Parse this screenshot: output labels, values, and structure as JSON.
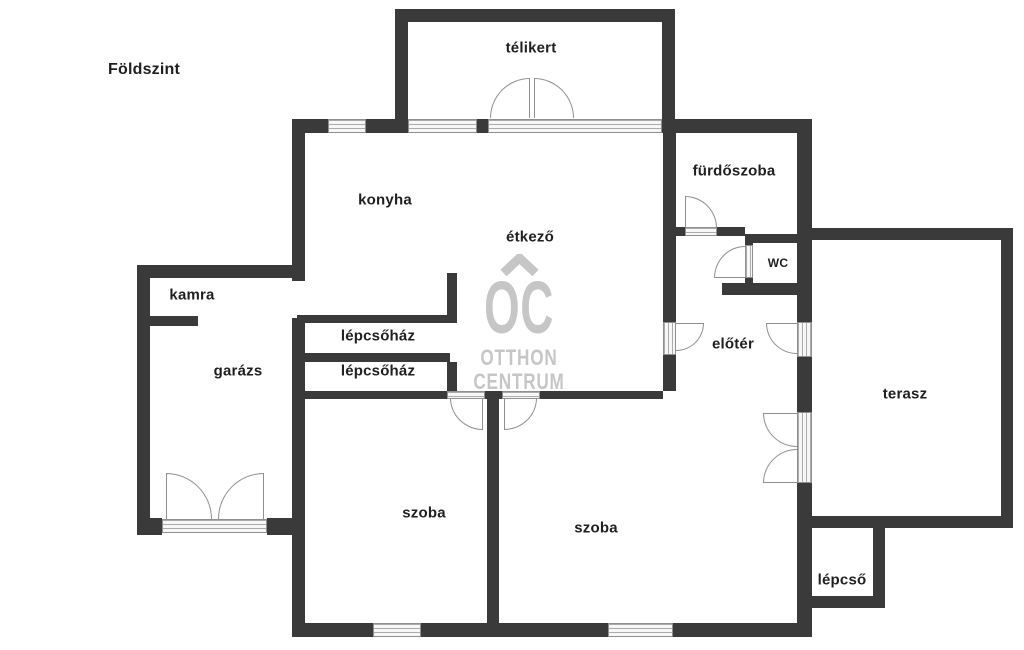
{
  "title": "Földszint",
  "watermark": {
    "logo": "OC",
    "line1": "OTTHON",
    "line2": "CENTRUM",
    "color": "#c4c4c4"
  },
  "colors": {
    "wall": "#3a3a3a",
    "window_fill": "#f7f7f7",
    "window_line": "#ababab",
    "door_arc": "#8f8f8f",
    "label_text": "#1f1f1f",
    "background": "#ffffff"
  },
  "rooms": [
    {
      "id": "telikert",
      "label": "télikert"
    },
    {
      "id": "konyha",
      "label": "konyha"
    },
    {
      "id": "etkezo",
      "label": "étkező"
    },
    {
      "id": "furdoszoba",
      "label": "fürdőszoba"
    },
    {
      "id": "wc",
      "label": "wc"
    },
    {
      "id": "kamra",
      "label": "kamra"
    },
    {
      "id": "garazs",
      "label": "garázs"
    },
    {
      "id": "lepcsohaz-felso",
      "label": "lépcsőház"
    },
    {
      "id": "lepcsohaz-also",
      "label": "lépcsőház"
    },
    {
      "id": "eloter",
      "label": "előtér"
    },
    {
      "id": "terasz",
      "label": "terasz"
    },
    {
      "id": "szoba-bal",
      "label": "szoba"
    },
    {
      "id": "szoba-jobb",
      "label": "szoba"
    },
    {
      "id": "lepcso",
      "label": "lépcső"
    }
  ]
}
